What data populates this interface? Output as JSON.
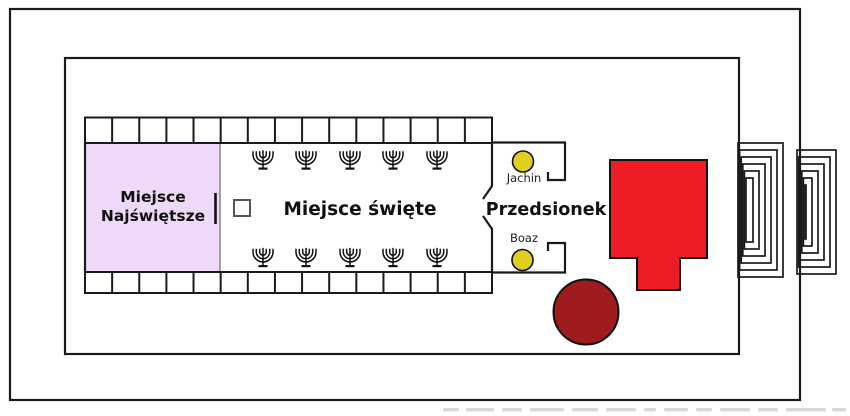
{
  "diagram": {
    "kind": "temple-floor-plan",
    "rooms": {
      "holy_of_holies": {
        "label_line1": "Miejsce",
        "label_line2": "Najświętsze",
        "fill": "#eed9f8"
      },
      "holy_place": {
        "label": "Miejsce święte",
        "fill": "#ffffff"
      },
      "vestibule": {
        "label": "Przedsionek"
      }
    },
    "pillars": [
      {
        "label": "Jachin",
        "color": "#e0cf1d"
      },
      {
        "label": "Boaz",
        "color": "#e0cf1d"
      }
    ],
    "features": {
      "altar_of_burnt_offering_color": "#ee1c24",
      "molten_sea_color": "#9e1b1e",
      "menorah_count": 10,
      "incense_altar": "small-square",
      "side_chambers_top": 15,
      "side_chambers_bottom": 15,
      "east_gates": 2
    },
    "line_color": "#1a1a1a"
  }
}
